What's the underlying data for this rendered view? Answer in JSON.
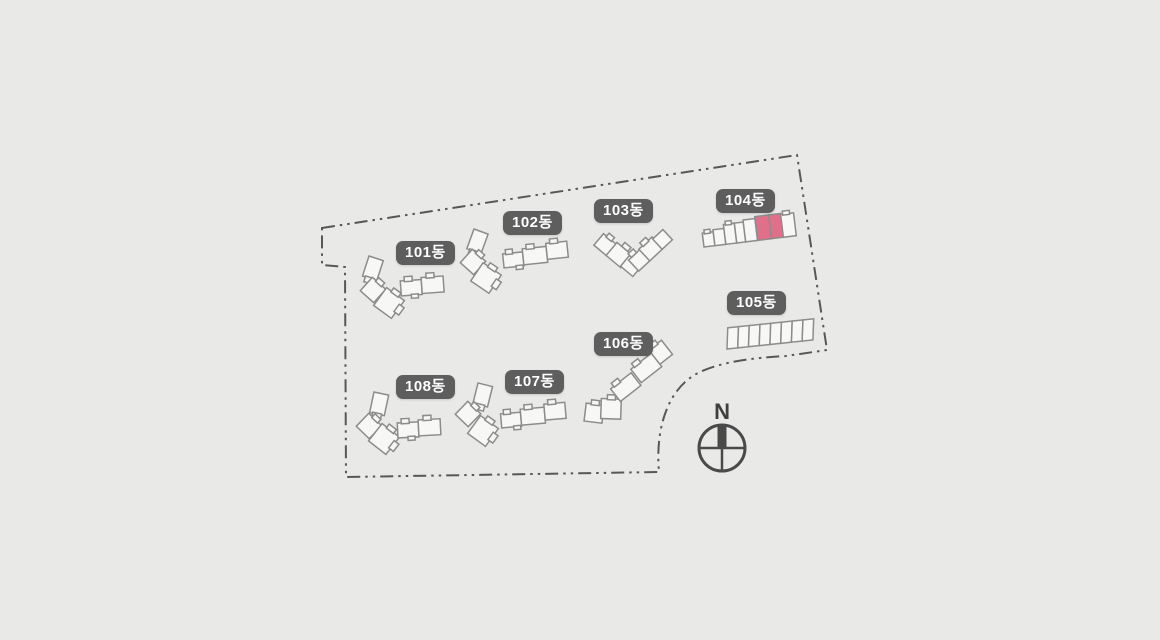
{
  "site_plan": {
    "background_color": "#e9eae8",
    "boundary_color": "#575757",
    "building_outline_color": "#8c8c8c",
    "building_fill_color": "#f7f7f6",
    "highlight_color": "#e0708a",
    "badge_background_color": "#5e5e5e",
    "badge_text_color": "#ffffff",
    "buildings": [
      {
        "id": "101",
        "label": "101동",
        "highlighted": false
      },
      {
        "id": "102",
        "label": "102동",
        "highlighted": false
      },
      {
        "id": "103",
        "label": "103동",
        "highlighted": false
      },
      {
        "id": "104",
        "label": "104동",
        "highlighted": true,
        "highlighted_unit_count": 2
      },
      {
        "id": "105",
        "label": "105동",
        "highlighted": false
      },
      {
        "id": "106",
        "label": "106동",
        "highlighted": false
      },
      {
        "id": "107",
        "label": "107동",
        "highlighted": false
      },
      {
        "id": "108",
        "label": "108동",
        "highlighted": false
      }
    ],
    "compass": {
      "label": "N"
    }
  }
}
